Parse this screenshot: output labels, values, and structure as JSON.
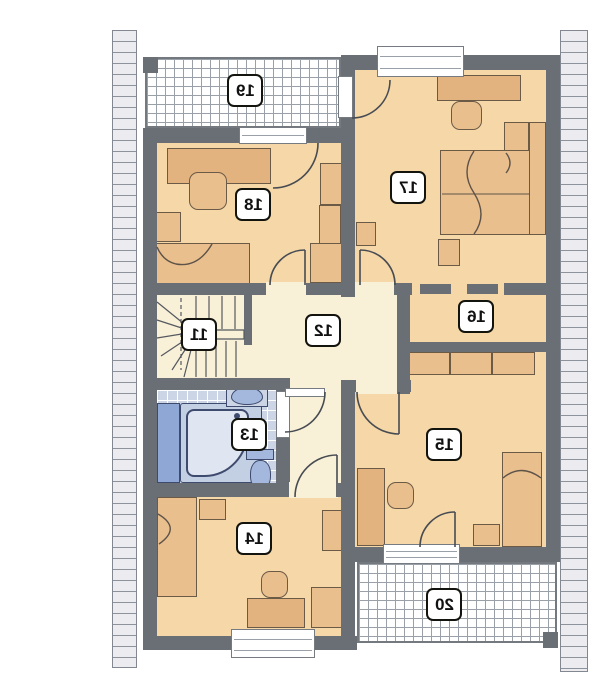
{
  "plan": {
    "type": "floor-plan",
    "mirrored": true,
    "room_labels": [
      "11",
      "12",
      "13",
      "14",
      "15",
      "16",
      "17",
      "18",
      "19",
      "20"
    ]
  },
  "colors": {
    "wall": "#6a6e75",
    "room_floor": "#f5d7a8",
    "hall_floor": "#f9f0d8",
    "furniture": "#eabf8e",
    "bath_tile": "#ccd5e6",
    "bath_fixture": "#a3b8dc",
    "roof_hatch": "#ececf0",
    "balcony_grid_line": "#9aa0a8"
  }
}
